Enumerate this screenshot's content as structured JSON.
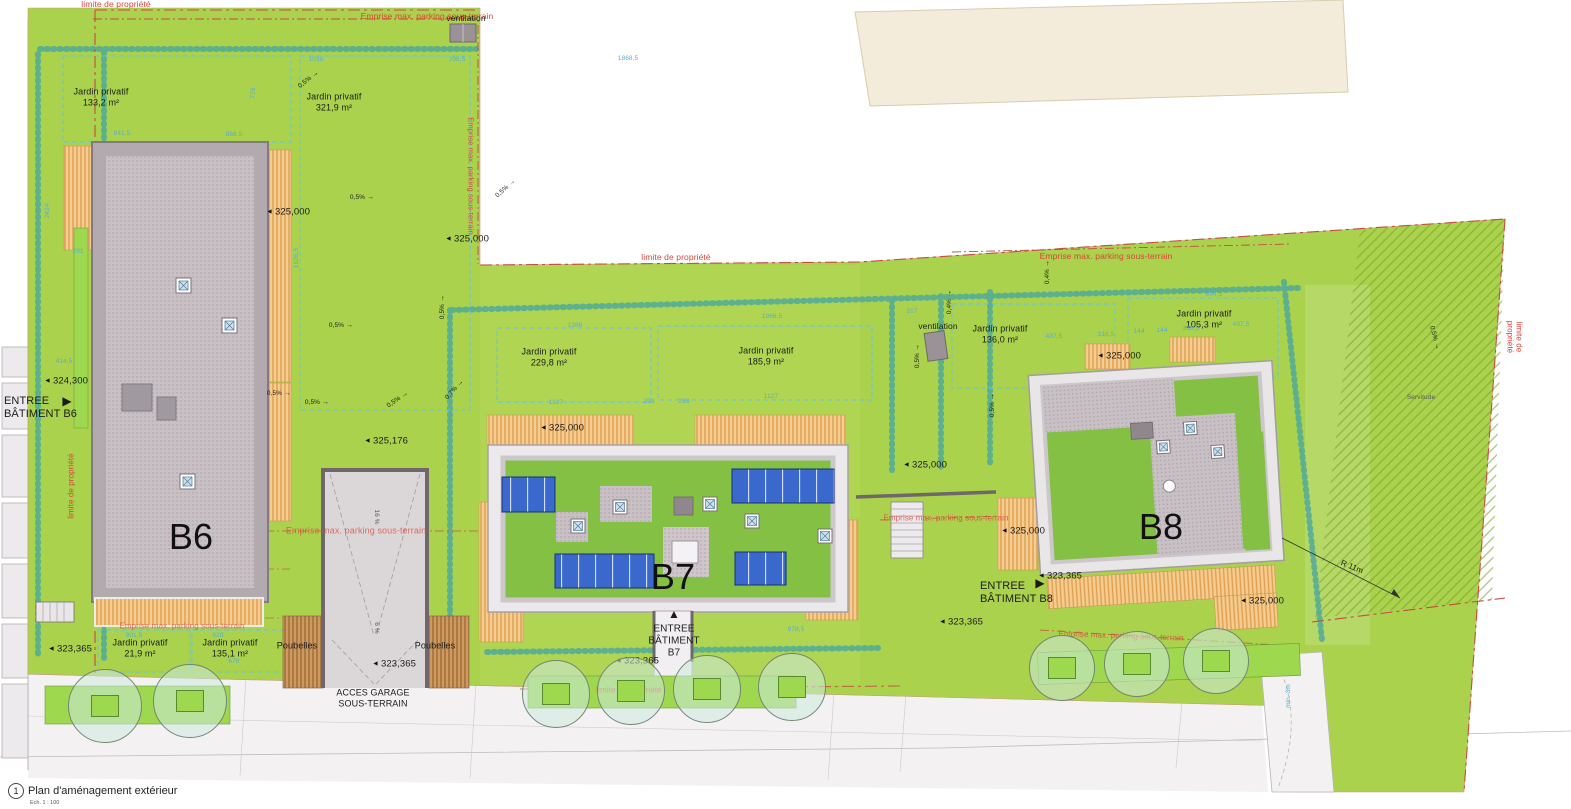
{
  "title": {
    "num": "1",
    "text": "Plan d'aménagement extérieur",
    "scale": "Ech. 1 : 100"
  },
  "colors": {
    "site_green": "#aad24c",
    "roof_green": "#83c043",
    "property_red": "#d8453c",
    "dim_blue": "#58aecb",
    "solar_blue": "#3a68cc",
    "terrace_orange": "#f6cd8e",
    "existing_beige": "#f3ecda"
  },
  "labels": [
    {
      "n": "limite-top",
      "t": "limite de propriété",
      "x": 116,
      "y": 4,
      "s": 8.5,
      "c": "r"
    },
    {
      "n": "emprise-top",
      "t": "Emprise max. parking sous-terrain",
      "x": 427,
      "y": 16,
      "s": 8.5,
      "c": "r"
    },
    {
      "n": "ventilation-1",
      "t": "ventilation",
      "x": 466,
      "y": 18,
      "s": 8.5
    },
    {
      "n": "jardin-133",
      "t": "Jardin privatif\n133,2 m²",
      "x": 101,
      "y": 97,
      "s": 9
    },
    {
      "n": "jardin-321",
      "t": "Jardin privatif\n321,9 m²",
      "x": 334,
      "y": 102,
      "s": 9
    },
    {
      "n": "emprise-right-b6",
      "t": "Emprise max. parking sous-terrain",
      "x": 470,
      "y": 176,
      "s": 7.5,
      "c": "r",
      "r": 90
    },
    {
      "n": "limite-left",
      "t": "limite de propriété",
      "x": 71,
      "y": 486,
      "s": 8,
      "c": "r",
      "r": -90
    },
    {
      "n": "limite-mid",
      "t": "limite de propriété",
      "x": 676,
      "y": 257,
      "s": 8.5,
      "c": "r"
    },
    {
      "n": "emprise-b8-top",
      "t": "Emprise max. parking sous-terrain",
      "x": 1106,
      "y": 256,
      "s": 8.5,
      "c": "r"
    },
    {
      "n": "ventilation-2",
      "t": "ventilation",
      "x": 938,
      "y": 326,
      "s": 8.5
    },
    {
      "n": "jardin-229",
      "t": "Jardin privatif\n229,8 m²",
      "x": 549,
      "y": 357,
      "s": 9
    },
    {
      "n": "jardin-185",
      "t": "Jardin privatif\n185,9 m²",
      "x": 766,
      "y": 356,
      "s": 9
    },
    {
      "n": "jardin-136",
      "t": "Jardin privatif\n136,0 m²",
      "x": 1000,
      "y": 334,
      "s": 9
    },
    {
      "n": "jardin-105",
      "t": "Jardin privatif\n105,3 m²",
      "x": 1204,
      "y": 319,
      "s": 9
    },
    {
      "n": "building-b6",
      "t": "B6",
      "x": 191,
      "y": 537,
      "s": 36,
      "c": "big"
    },
    {
      "n": "building-b7",
      "t": "B7",
      "x": 673,
      "y": 577,
      "s": 36,
      "c": "big"
    },
    {
      "n": "building-b8",
      "t": "B8",
      "x": 1161,
      "y": 527,
      "s": 36,
      "c": "big"
    },
    {
      "n": "entree-b6",
      "t": "ENTREE\nBÂTIMENT B6",
      "x": 4,
      "y": 408,
      "s": 11,
      "a": "l"
    },
    {
      "n": "entree-b6-arrow",
      "t": "▶",
      "x": 67,
      "y": 401,
      "s": 12
    },
    {
      "n": "emprise-b6",
      "t": "Emprise max. parking sous-terrain",
      "x": 356,
      "y": 531,
      "s": 9,
      "c": "r",
      "o": 0.75
    },
    {
      "n": "slope-16pct",
      "t": "16 %",
      "x": 376,
      "y": 517,
      "s": 6.5,
      "r": 90,
      "c": "g2"
    },
    {
      "n": "slope-6pct",
      "t": "6 %",
      "x": 376,
      "y": 628,
      "s": 6.5,
      "r": 90,
      "c": "g2"
    },
    {
      "n": "emprise-b7-b8",
      "t": "Emprise max. parking sous-terrain",
      "x": 946,
      "y": 518,
      "s": 8,
      "c": "r",
      "o": 0.8
    },
    {
      "n": "entree-b8",
      "t": "ENTREE\nBÂTIMENT B8",
      "x": 980,
      "y": 593,
      "s": 11,
      "a": "l"
    },
    {
      "n": "entree-b8-arrow",
      "t": "▶",
      "x": 1040,
      "y": 583,
      "s": 12
    },
    {
      "n": "emprise-b8-bottom",
      "t": "Emprise max. parking sous-terrain",
      "x": 1121,
      "y": 636,
      "s": 8,
      "c": "r",
      "r": 2,
      "o": 0.8
    },
    {
      "n": "limite-right",
      "t": "limite de propriété",
      "x": 1514,
      "y": 337,
      "s": 8,
      "c": "r",
      "r": 90
    },
    {
      "n": "servitude",
      "t": "Servitude",
      "x": 1421,
      "y": 398,
      "s": 6.5,
      "c": "g2"
    },
    {
      "n": "radius-11m",
      "t": "R 11m",
      "x": 1352,
      "y": 567,
      "s": 8,
      "r": 22
    },
    {
      "n": "emprise-bottom-left",
      "t": "Emprise max. parking sous-terrain",
      "x": 182,
      "y": 626,
      "s": 8,
      "c": "r",
      "o": 0.7
    },
    {
      "n": "jardin-21",
      "t": "Jardin privatif\n21,9 m²",
      "x": 140,
      "y": 648,
      "s": 9
    },
    {
      "n": "jardin-135",
      "t": "Jardin privatif\n135,1 m²",
      "x": 230,
      "y": 648,
      "s": 9
    },
    {
      "n": "poubelles-1",
      "t": "Poubelles",
      "x": 297,
      "y": 646,
      "s": 9
    },
    {
      "n": "poubelles-2",
      "t": "Poubelles",
      "x": 435,
      "y": 646,
      "s": 9
    },
    {
      "n": "entree-b7",
      "t": "ENTREE\nBÂTIMENT\nB7",
      "x": 674,
      "y": 641,
      "s": 10
    },
    {
      "n": "entree-b7-arrow",
      "t": "▲",
      "x": 674,
      "y": 614,
      "s": 12
    },
    {
      "n": "limite-bottom-b7",
      "t": "limite de propriété",
      "x": 629,
      "y": 690,
      "s": 8,
      "c": "r",
      "o": 0.85
    },
    {
      "n": "acces-garage",
      "t": "ACCES GARAGE\nSOUS-TERRAIN",
      "x": 373,
      "y": 698,
      "s": 9
    }
  ],
  "elevation_markers": [
    {
      "t": "324,300",
      "x": 66,
      "y": 381
    },
    {
      "t": "325,000",
      "x": 288,
      "y": 212
    },
    {
      "t": "325,000",
      "x": 467,
      "y": 239
    },
    {
      "t": "325,176",
      "x": 386,
      "y": 441
    },
    {
      "t": "325,000",
      "x": 562,
      "y": 428
    },
    {
      "t": "325,000",
      "x": 925,
      "y": 465
    },
    {
      "t": "325,000",
      "x": 1119,
      "y": 356
    },
    {
      "t": "325,000",
      "x": 1023,
      "y": 531
    },
    {
      "t": "325,000",
      "x": 1262,
      "y": 601
    },
    {
      "t": "323,365",
      "x": 70,
      "y": 649
    },
    {
      "t": "323,365",
      "x": 394,
      "y": 664
    },
    {
      "t": "323,365",
      "x": 637,
      "y": 661
    },
    {
      "t": "323,365",
      "x": 961,
      "y": 622
    },
    {
      "t": "323,365",
      "x": 1060,
      "y": 576
    }
  ],
  "dimensions": [
    {
      "t": "1038",
      "x": 316,
      "y": 60
    },
    {
      "t": "1868,5",
      "x": 628,
      "y": 59
    },
    {
      "t": "398,5",
      "x": 457,
      "y": 60
    },
    {
      "t": "841,5",
      "x": 122,
      "y": 134
    },
    {
      "t": "868,5",
      "x": 234,
      "y": 135
    },
    {
      "t": "776",
      "x": 254,
      "y": 93,
      "r": -90
    },
    {
      "t": "2424",
      "x": 48,
      "y": 211,
      "r": -90
    },
    {
      "t": "291",
      "x": 78,
      "y": 252
    },
    {
      "t": "414,5",
      "x": 64,
      "y": 362
    },
    {
      "t": "1626,5",
      "x": 297,
      "y": 258,
      "r": -90
    },
    {
      "t": "1386",
      "x": 575,
      "y": 326
    },
    {
      "t": "1966,5",
      "x": 772,
      "y": 317
    },
    {
      "t": "1127",
      "x": 556,
      "y": 403
    },
    {
      "t": "293",
      "x": 649,
      "y": 402
    },
    {
      "t": "288",
      "x": 684,
      "y": 402
    },
    {
      "t": "1127",
      "x": 771,
      "y": 397
    },
    {
      "t": "317",
      "x": 912,
      "y": 312
    },
    {
      "t": "894,5",
      "x": 1214,
      "y": 295
    },
    {
      "t": "437,5",
      "x": 1054,
      "y": 337
    },
    {
      "t": "316,5",
      "x": 1106,
      "y": 335
    },
    {
      "t": "144",
      "x": 1139,
      "y": 332
    },
    {
      "t": "144",
      "x": 1162,
      "y": 331
    },
    {
      "t": "318,5",
      "x": 1191,
      "y": 329
    },
    {
      "t": "437,5",
      "x": 1241,
      "y": 325
    },
    {
      "t": "978,5",
      "x": 796,
      "y": 630
    },
    {
      "t": "901,5",
      "x": 134,
      "y": 636
    },
    {
      "t": "628",
      "x": 218,
      "y": 636
    },
    {
      "t": "678",
      "x": 234,
      "y": 662
    },
    {
      "t": "min. 3m",
      "x": 1289,
      "y": 696,
      "r": -90
    }
  ],
  "slopes": [
    {
      "t": "0,5%",
      "x": 309,
      "y": 80,
      "r": -38
    },
    {
      "t": "0,5%",
      "x": 362,
      "y": 198,
      "r": 0
    },
    {
      "t": "0,5%",
      "x": 341,
      "y": 326,
      "r": 0
    },
    {
      "t": "0,5%",
      "x": 279,
      "y": 394,
      "r": 0
    },
    {
      "t": "0,5%",
      "x": 317,
      "y": 403,
      "r": 0
    },
    {
      "t": "0,5%",
      "x": 398,
      "y": 400,
      "r": -35
    },
    {
      "t": "0,5%",
      "x": 506,
      "y": 189,
      "r": -42
    },
    {
      "t": "0,5%",
      "x": 443,
      "y": 307,
      "r": -90
    },
    {
      "t": "0,7%",
      "x": 455,
      "y": 390,
      "r": -48
    },
    {
      "t": "0,4%",
      "x": 1048,
      "y": 272,
      "r": -90
    },
    {
      "t": "0,4%",
      "x": 950,
      "y": 302,
      "r": -90
    },
    {
      "t": "0,5%",
      "x": 918,
      "y": 356,
      "r": -90
    },
    {
      "t": "0,5%",
      "x": 993,
      "y": 405,
      "r": -90
    },
    {
      "t": "0,5%",
      "x": 1434,
      "y": 338,
      "r": 75
    }
  ],
  "trees": [
    {
      "x": 105,
      "y": 706,
      "d": 72
    },
    {
      "x": 190,
      "y": 701,
      "d": 72
    },
    {
      "x": 556,
      "y": 694,
      "d": 66
    },
    {
      "x": 631,
      "y": 691,
      "d": 66
    },
    {
      "x": 707,
      "y": 689,
      "d": 66
    },
    {
      "x": 792,
      "y": 687,
      "d": 66
    },
    {
      "x": 1062,
      "y": 668,
      "d": 64
    },
    {
      "x": 1137,
      "y": 664,
      "d": 64
    },
    {
      "x": 1216,
      "y": 661,
      "d": 64
    }
  ]
}
